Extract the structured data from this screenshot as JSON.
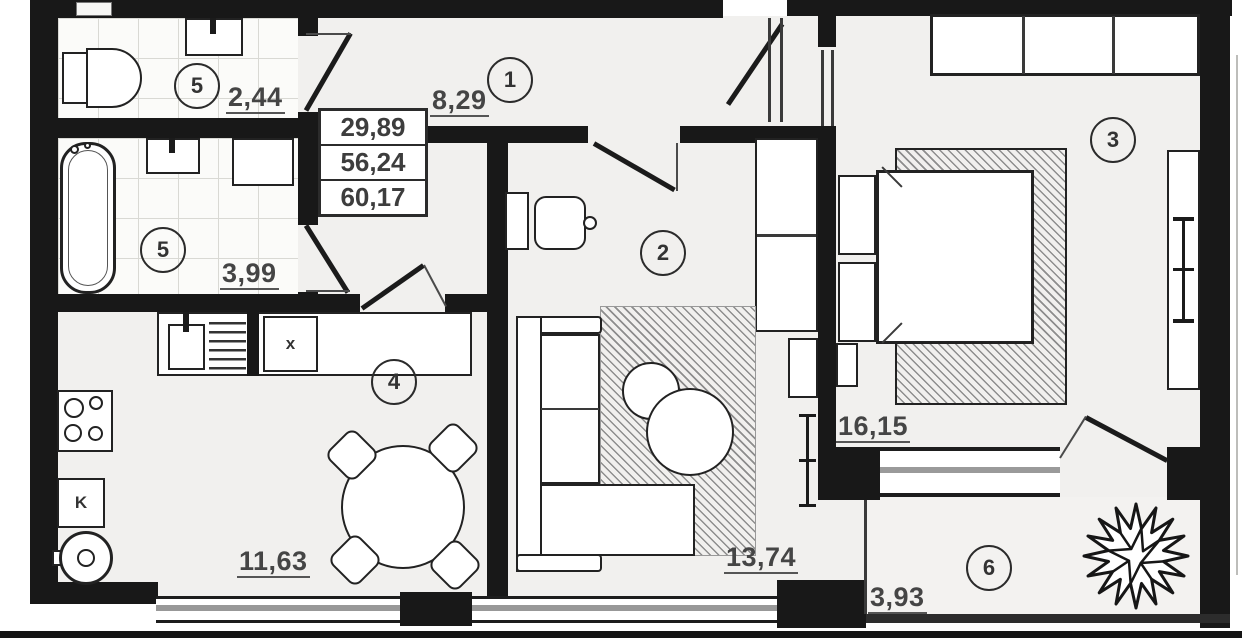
{
  "plan": {
    "type": "apartment-floor-plan",
    "colors": {
      "wall": "#181818",
      "floor": "#f1f0ee",
      "label": "#454545"
    },
    "area_table": {
      "values": [
        "29,89",
        "56,24",
        "60,17"
      ]
    },
    "rooms": {
      "hallway": {
        "number": "1",
        "area": "8,29"
      },
      "living": {
        "number": "2",
        "area": "13,74"
      },
      "bedroom": {
        "number": "3",
        "area": "16,15"
      },
      "kitchen": {
        "number": "4",
        "area": "11,63"
      },
      "wc": {
        "number": "5",
        "area": "2,44"
      },
      "bathroom": {
        "number": "5",
        "area": "3,99"
      },
      "balcony": {
        "number": "6",
        "area": "3,93"
      }
    },
    "markers": {
      "boiler_label": "K",
      "duct_label": "x"
    }
  }
}
